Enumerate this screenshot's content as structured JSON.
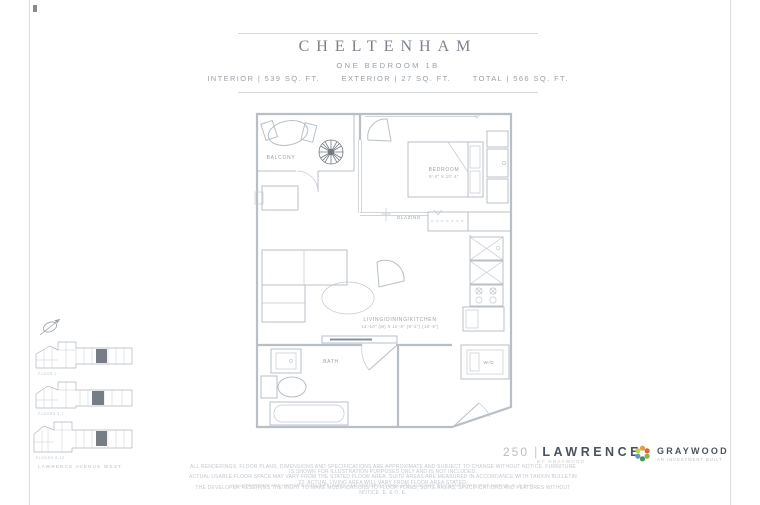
{
  "header": {
    "title": "CHELTENHAM",
    "subtitle": "ONE BEDROOM 1B",
    "stats": [
      "INTERIOR | 539 SQ. FT.",
      "EXTERIOR | 27 SQ. FT.",
      "TOTAL | 566 SQ. FT."
    ]
  },
  "plan": {
    "balcony_label": "BALCONY",
    "bedroom_label": "BEDROOM",
    "bedroom_dims": "9'-0\" X 10'-4\"",
    "glazing_label": "GLAZING",
    "living_label": "LIVING/DINING/KITCHEN",
    "living_dims": "14'-10\" (M) X 11'-9\" (9'-2\") (10'-9\")",
    "bath_label": "BATH",
    "washer_dryer_label": "W/D"
  },
  "keyplans": {
    "captions": [
      "FLOOR 2",
      "FLOORS 3-7",
      "FLOORS 8-12"
    ],
    "street": "LAWRENCE AVENUE WEST"
  },
  "footer": {
    "brand_number": "250",
    "brand_divider": "|",
    "brand_name": "LAWRENCE",
    "brand_sub": "BY GRAYWOOD",
    "developer_name": "GRAYWOOD",
    "developer_tagline": "AN INVESTMENT BUILT",
    "disclaimer_lines": [
      "ALL RENDERINGS, FLOOR PLANS, DIMENSIONS AND SPECIFICATIONS ARE APPROXIMATE AND SUBJECT TO CHANGE WITHOUT NOTICE. FURNITURE IS SHOWN FOR ILLUSTRATION PURPOSES ONLY AND IS NOT INCLUDED.",
      "ACTUAL USABLE FLOOR SPACE MAY VARY FROM THE STATED FLOOR AREA. SUITE AREAS ARE MEASURED IN ACCORDANCE WITH TARION BULLETIN 22. ACTUAL LIVING AREA WILL VARY FROM FLOOR AREA STATED.",
      "THE DEVELOPER RESERVES THE RIGHT TO MAKE MODIFICATIONS TO FLOOR PLANS, SUITE AREAS, SPECIFICATIONS AND FEATURES WITHOUT NOTICE. E. & O. E."
    ],
    "disclaimer_footnote": "ILLUSTRATIONS ARE ARTIST'S CONCEPT. SIZES AND SPECIFICATIONS ARE SUBJECT TO CHANGE WITHOUT NOTICE. E. & O. E."
  }
}
